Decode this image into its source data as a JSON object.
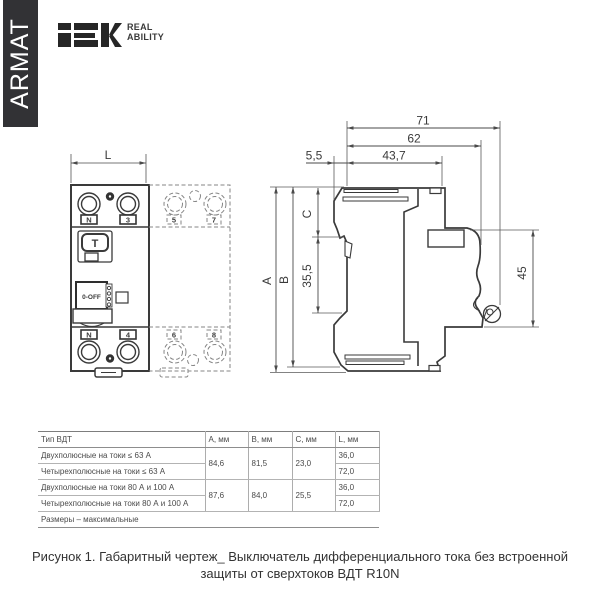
{
  "sidebar": {
    "brand": "ARMAT"
  },
  "header": {
    "logo": "IEK",
    "tagline_line1": "REAL",
    "tagline_line2": "ABILITY"
  },
  "drawing": {
    "front_view": {
      "width_dim": "L",
      "terminals_top": [
        "N",
        "3",
        "5",
        "7"
      ],
      "terminals_bottom": [
        "N",
        "4",
        "6",
        "8"
      ],
      "test_button_label": "T",
      "toggle_label": "0-OFF"
    },
    "side_view": {
      "dim_71": "71",
      "dim_62": "62",
      "dim_5_5": "5,5",
      "dim_43_7": "43,7",
      "dim_a": "A",
      "dim_b": "B",
      "dim_c": "C",
      "dim_35_5": "35,5",
      "dim_45": "45"
    }
  },
  "table": {
    "headers": [
      "Тип ВДТ",
      "A, мм",
      "B, мм",
      "C, мм",
      "L, мм"
    ],
    "rows": [
      {
        "type": "Двухполюсные на токи ≤ 63 А",
        "a": "84,6",
        "b": "81,5",
        "c": "23,0",
        "l": "36,0"
      },
      {
        "type": "Четырехполюсные на токи ≤ 63 А",
        "l": "72,0"
      },
      {
        "type": "Двухполюсные на токи 80 А и 100 А",
        "a": "87,6",
        "b": "84,0",
        "c": "25,5",
        "l": "36,0"
      },
      {
        "type": "Четырехполюсные на токи 80 А и 100 А",
        "l": "72,0"
      }
    ],
    "note": "Размеры – максимальные"
  },
  "caption": {
    "line1": "Рисунок 1. Габаритный чертеж_ Выключатель дифференциального тока без встроенной",
    "line2": "защиты от сверхтоков ВДТ R10N"
  },
  "colors": {
    "brand_bar": "#323235",
    "ink": "#3a3a3a",
    "dashed_line": "#858585",
    "table_line": "#adadad"
  }
}
